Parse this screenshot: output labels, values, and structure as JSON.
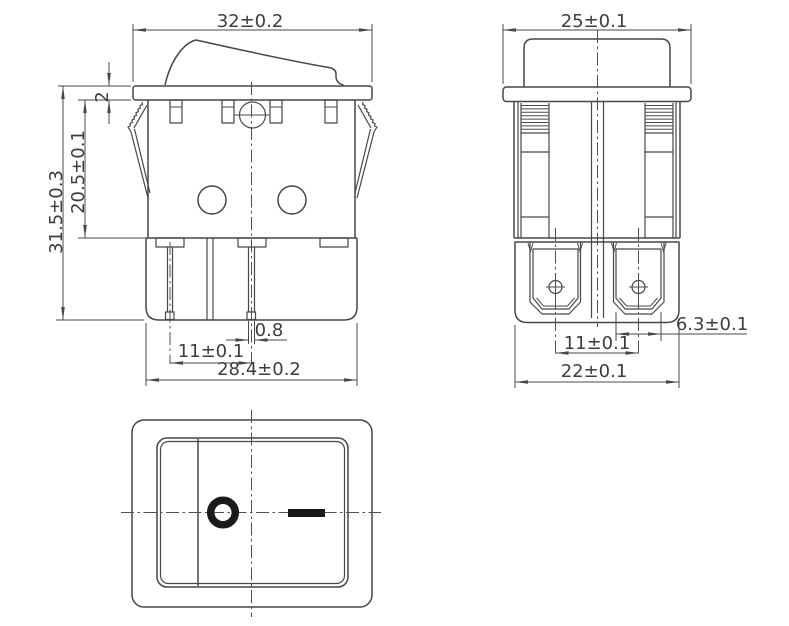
{
  "drawing": {
    "kind": "rocker switch 3-view dimension drawing",
    "colors": {
      "background": "#ffffff",
      "line": "#474747",
      "dimension_text": "#3d3d3d",
      "marking_symbol": "#1a1a1a"
    },
    "views": {
      "front": {
        "dimensions": {
          "overall_width": "32±0.2",
          "flange_thickness": "2",
          "body_height": "20.5±0.1",
          "overall_height": "31.5±0.3",
          "pin_thickness": "0.8",
          "pin_spacing": "11±0.1",
          "lower_body_width": "28.4±0.2"
        }
      },
      "side": {
        "dimensions": {
          "flange_width": "25±0.1",
          "terminal_width": "6.3±0.1",
          "terminal_spacing": "11±0.1",
          "lower_body_width": "22±0.1"
        }
      },
      "top": {
        "marking_off_symbol": "O",
        "marking_on_symbol": "—"
      }
    }
  }
}
